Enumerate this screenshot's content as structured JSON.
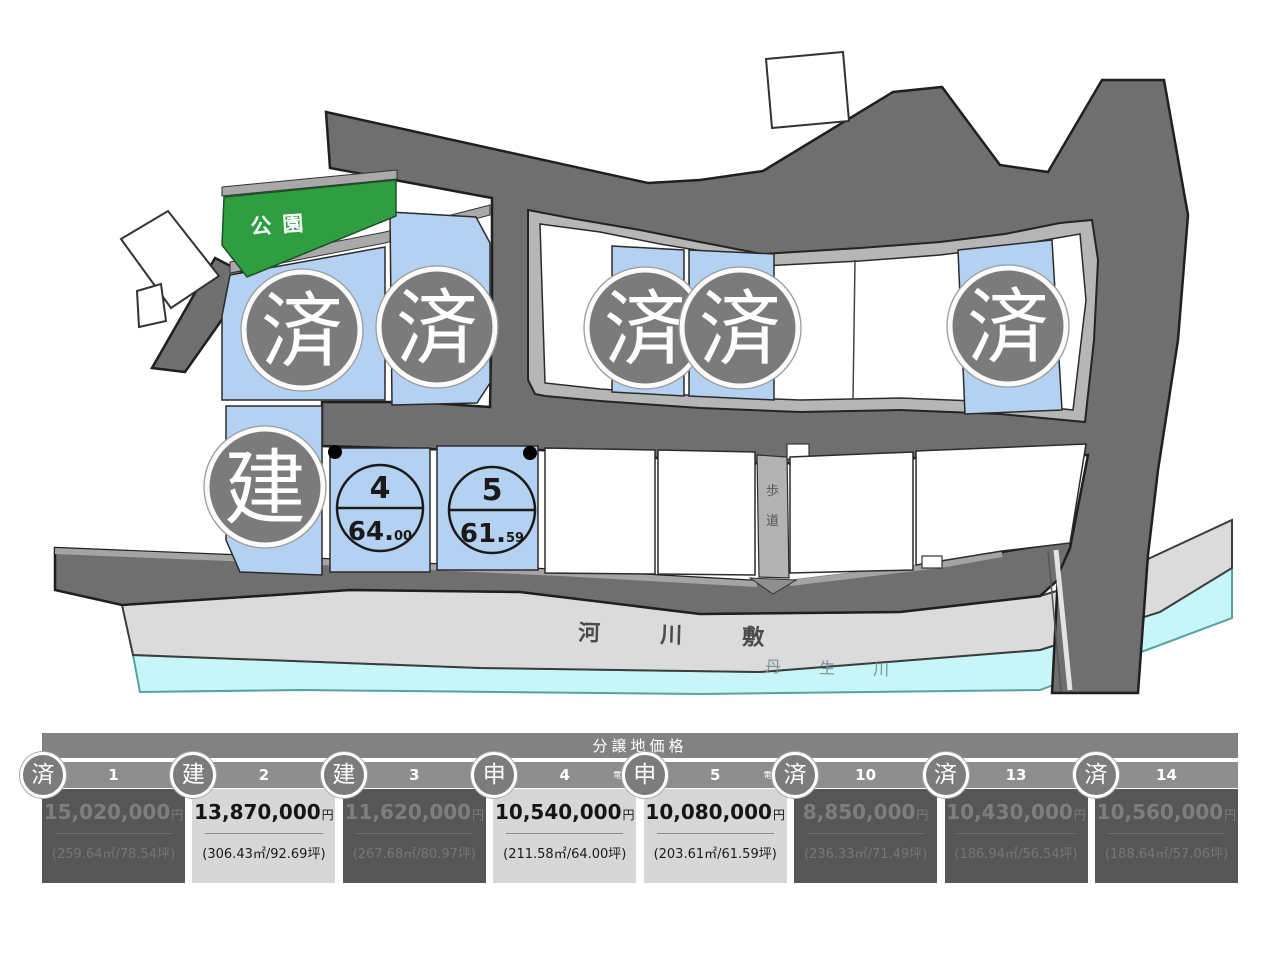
{
  "map": {
    "park_label": "公園",
    "riverbed_label": "河川敷",
    "river_label": "丹生川",
    "walkway_chars": {
      "top": "歩",
      "bottom": "道"
    },
    "badges": {
      "sold": "済",
      "built": "建",
      "applied": "申"
    },
    "lot_circles": [
      {
        "number": "4",
        "size_main": "64.",
        "size_sub": "00"
      },
      {
        "number": "5",
        "size_main": "61.",
        "size_sub": "59"
      }
    ],
    "colors": {
      "road": "#6f6f6f",
      "lot_blue": "#b4d1f2",
      "park_green": "#2e9e41",
      "riverbank": "#dbdbdb",
      "water": "#c8f6f8",
      "badge_gray": "#7b7b7b"
    }
  },
  "table": {
    "title": "分譲地価格",
    "columns": [
      {
        "badge": "済",
        "number": "1",
        "note": "",
        "price": "15,020,000",
        "unit": "円",
        "size": "(259.64㎡/78.54坪)",
        "status": "sold"
      },
      {
        "badge": "建",
        "number": "2",
        "note": "",
        "price": "13,870,000",
        "unit": "円",
        "size": "(306.43㎡/92.69坪)",
        "status": "available"
      },
      {
        "badge": "建",
        "number": "3",
        "note": "",
        "price": "11,620,000",
        "unit": "円",
        "size": "(267.68㎡/80.97坪)",
        "status": "sold"
      },
      {
        "badge": "申",
        "number": "4",
        "note": "電柱",
        "price": "10,540,000",
        "unit": "円",
        "size": "(211.58㎡/64.00坪)",
        "status": "available"
      },
      {
        "badge": "申",
        "number": "5",
        "note": "電柱",
        "price": "10,080,000",
        "unit": "円",
        "size": "(203.61㎡/61.59坪)",
        "status": "available"
      },
      {
        "badge": "済",
        "number": "10",
        "note": "",
        "price": "8,850,000",
        "unit": "円",
        "size": "(236.33㎡/71.49坪)",
        "status": "sold"
      },
      {
        "badge": "済",
        "number": "13",
        "note": "",
        "price": "10,430,000",
        "unit": "円",
        "size": "(186.94㎡/56.54坪)",
        "status": "sold"
      },
      {
        "badge": "済",
        "number": "14",
        "note": "",
        "price": "10,560,000",
        "unit": "円",
        "size": "(188.64㎡/57.06坪)",
        "status": "sold"
      }
    ]
  }
}
